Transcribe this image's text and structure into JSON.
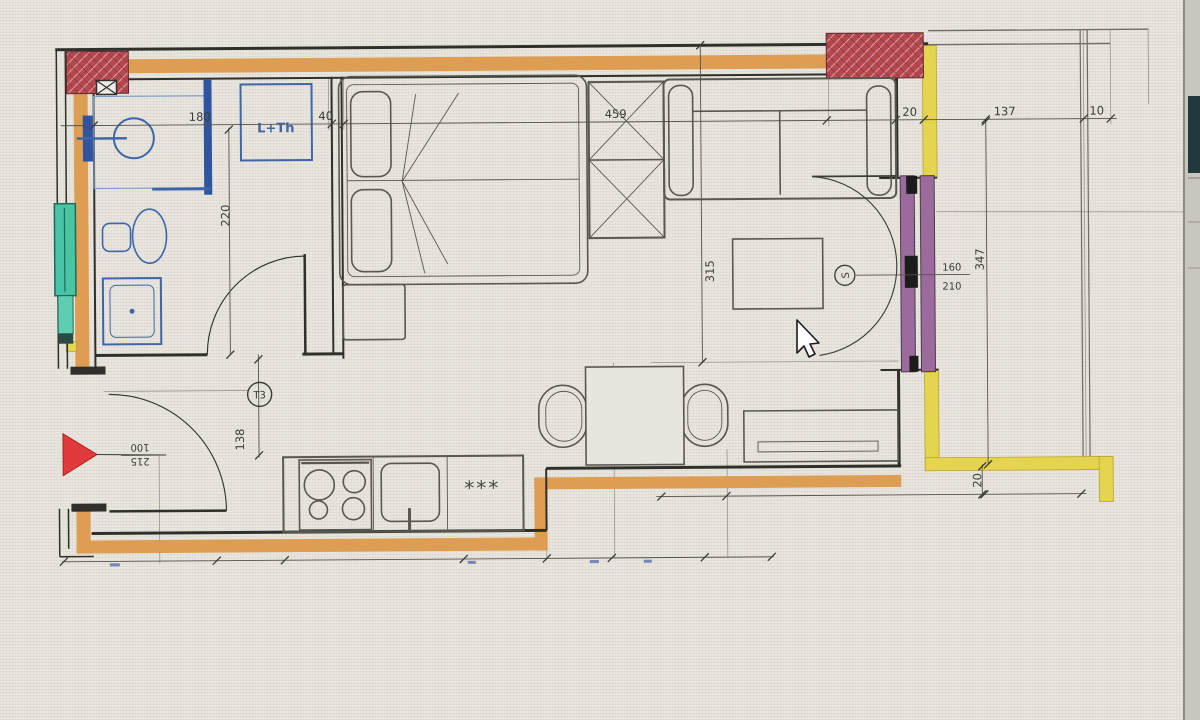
{
  "floor_plan": {
    "dimensions": {
      "bath_width": "180",
      "partition": "40",
      "bedroom_width": "459",
      "wall_thickness": "20",
      "terrace_width": "137",
      "terrace_edge": "10",
      "bath_depth": "220",
      "living_depth": "315",
      "right_depth": "347",
      "terrace_wall": "20",
      "hall_width": "138"
    },
    "doors": {
      "entry_width": "100",
      "entry_height": "215",
      "terrace_width": "160",
      "terrace_height": "210"
    },
    "labels": {
      "washer_dryer": "L+Th",
      "fridge": "***",
      "type_tag": "T3",
      "socket_tag": "S"
    },
    "colors": {
      "wall_orange": "#dd9d52",
      "wall_yellow": "#e5d44f",
      "column_red": "#b5474e",
      "door_purple": "#9b6b9b",
      "window_teal": "#49c4a4",
      "fixture_blue": "#3f66a8",
      "entry_marker": "#e03a3a"
    }
  }
}
